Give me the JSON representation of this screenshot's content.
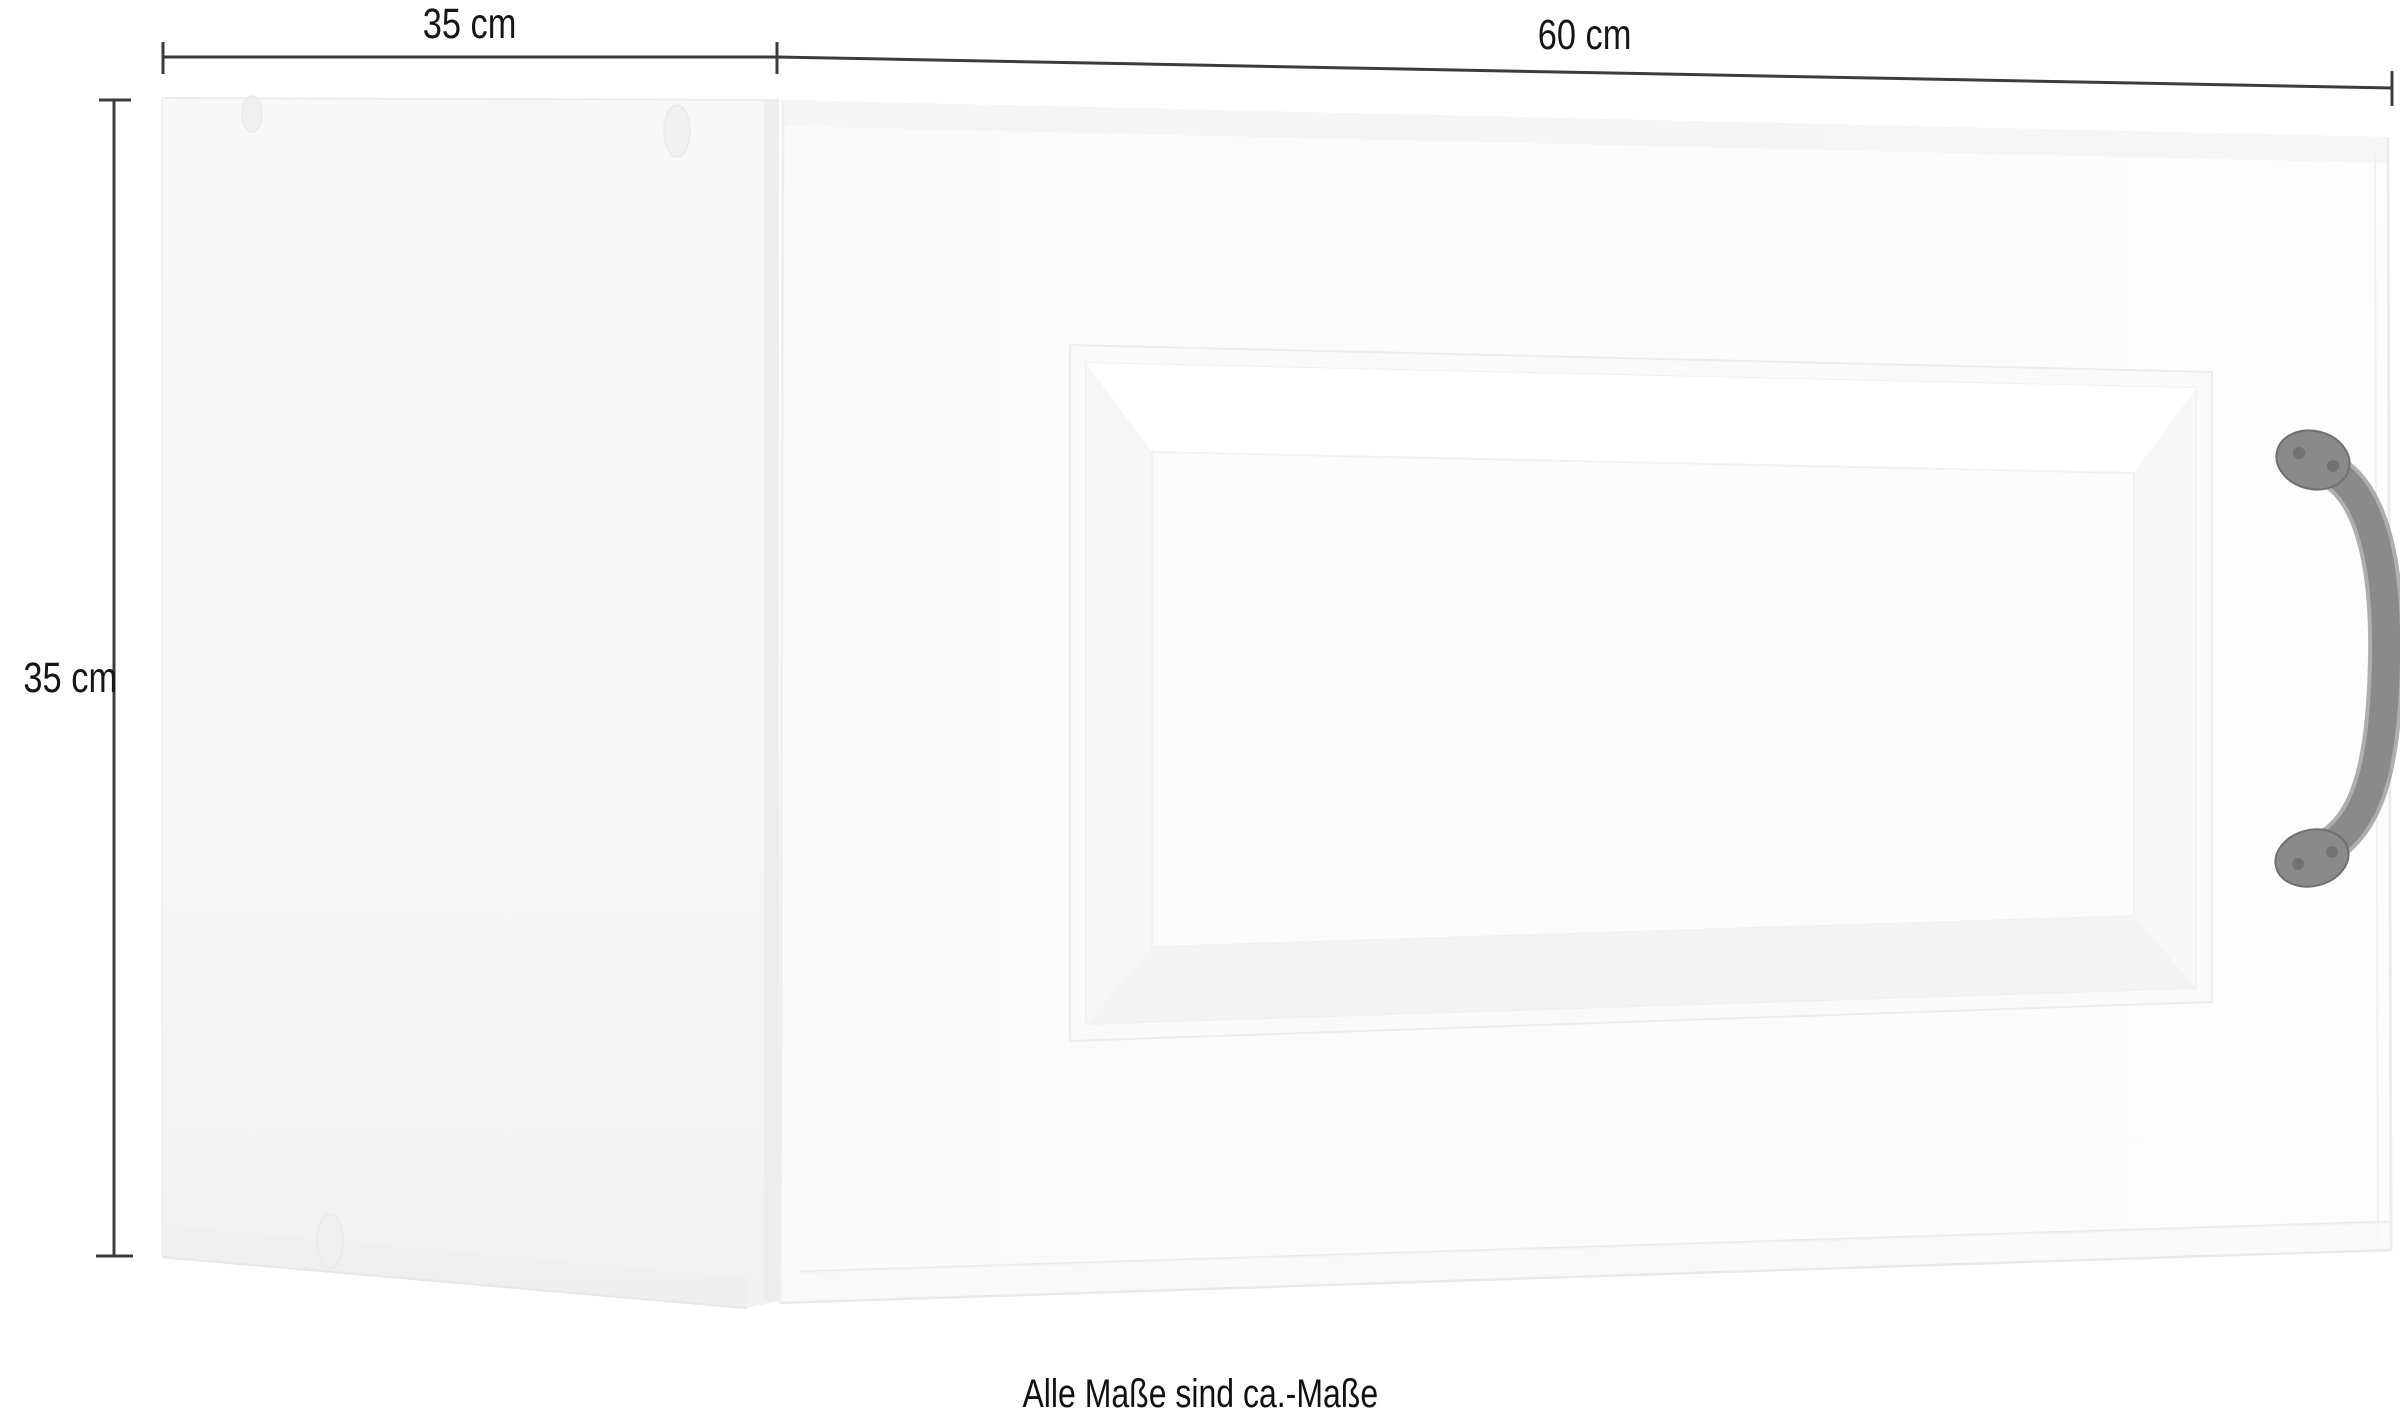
{
  "figure": {
    "kind": "furniture-dimension-diagram",
    "note": "Alle Maße sind ca.-Maße"
  },
  "dimensions": {
    "side_depth_label": "35 cm",
    "front_width_label": "60 cm",
    "height_label": "35 cm"
  },
  "colors": {
    "background": "#ffffff",
    "dimension_line": "#3c3c3c",
    "label_text": "#161616",
    "side_panel": "#f6f6f6",
    "door_face": "#fbfbfb",
    "handle": "#8a8a8a",
    "handle_outline": "#6e6e6e"
  }
}
